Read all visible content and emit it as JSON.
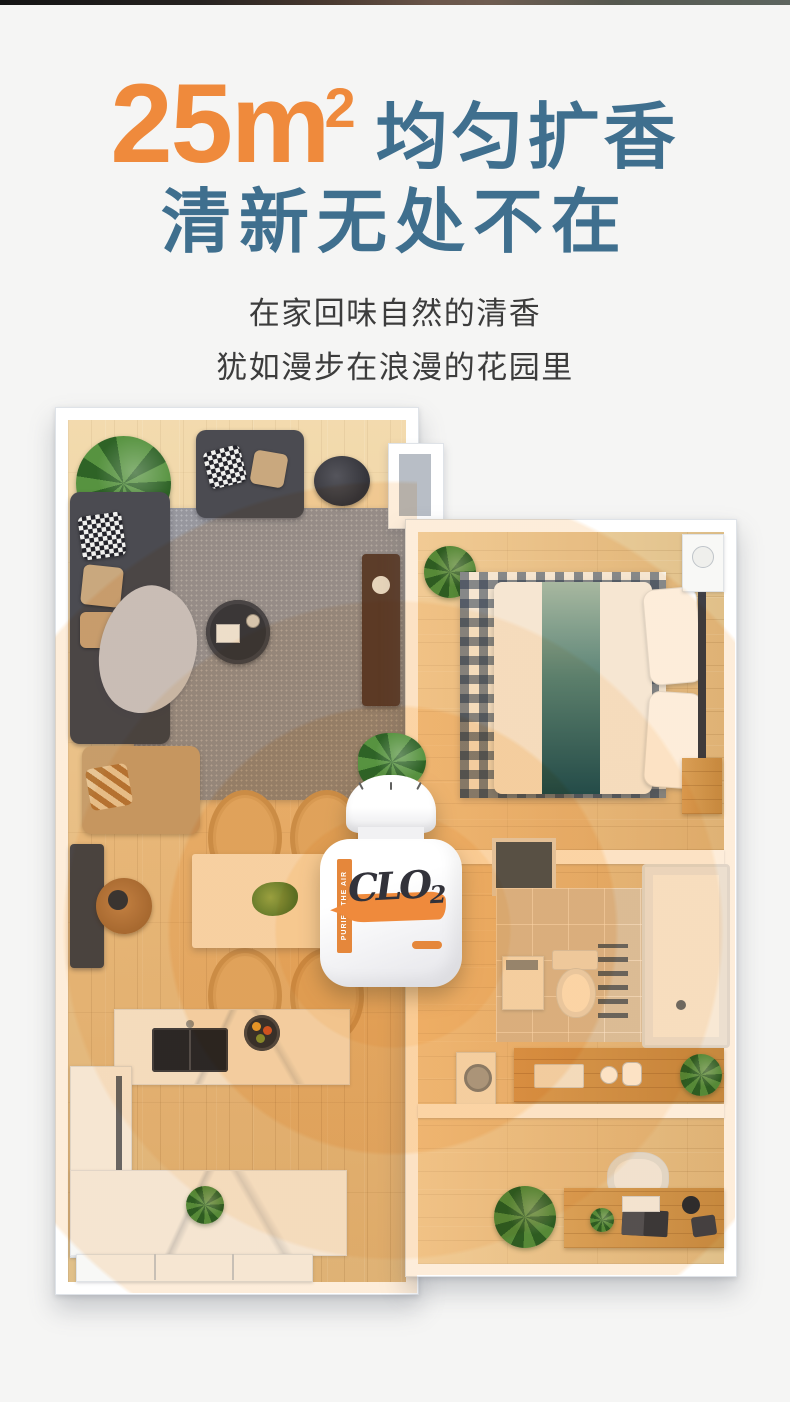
{
  "colors": {
    "bg": "#f5f5f4",
    "accent": "#ef8a3c",
    "title": "#3f6f8e",
    "text": "#3c3c3c",
    "ripple": "#f6a03a",
    "wood": "#e9cc98",
    "wall": "#ffffff"
  },
  "headline": {
    "area_number": "25m",
    "area_exponent": "2",
    "title_rest": "均匀扩香",
    "line2": "清新无处不在"
  },
  "subtitle": {
    "line1": "在家回味自然的清香",
    "line2": "犹如漫步在浪漫的花园里"
  },
  "product": {
    "brand": "CLO",
    "brand_exponent": "2",
    "side_label": "PURIFY THE AIR"
  }
}
